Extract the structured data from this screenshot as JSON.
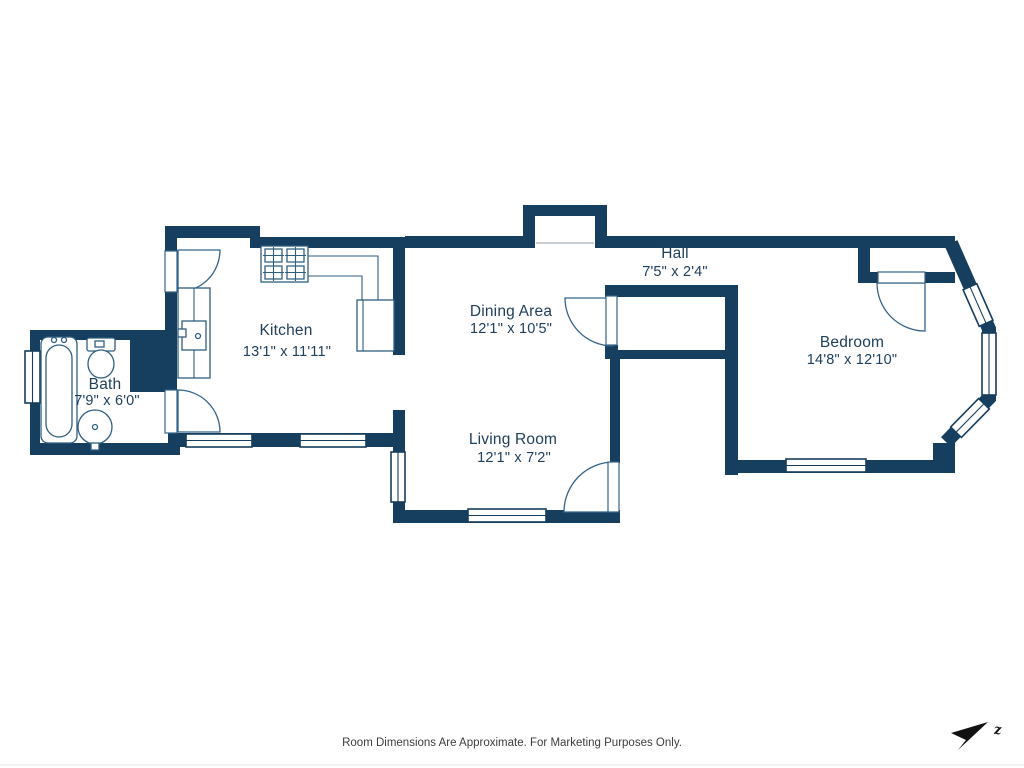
{
  "rooms": {
    "bath": {
      "name": "Bath",
      "dims": "7'9\" x 6'0\""
    },
    "kitchen": {
      "name": "Kitchen",
      "dims": "13'1\" x 11'11\""
    },
    "dining": {
      "name": "Dining Area",
      "dims": "12'1\" x 10'5\""
    },
    "living": {
      "name": "Living Room",
      "dims": "12'1\" x 7'2\""
    },
    "hall": {
      "name": "Hall",
      "dims": "7'5\" x 2'4\""
    },
    "bedroom": {
      "name": "Bedroom",
      "dims": "14'8\" x 12'10\""
    }
  },
  "footer": {
    "disclaimer": "Room Dimensions Are Approximate. For Marketing Purposes Only."
  },
  "compass": {
    "icon": "north-arrow",
    "label": "z"
  },
  "colors": {
    "wall": "#163e5e",
    "fixture_outline": "#2f5f80",
    "room_label": "#20405c",
    "disclaimer_text": "#3d3d3d",
    "background": "#ffffff"
  }
}
